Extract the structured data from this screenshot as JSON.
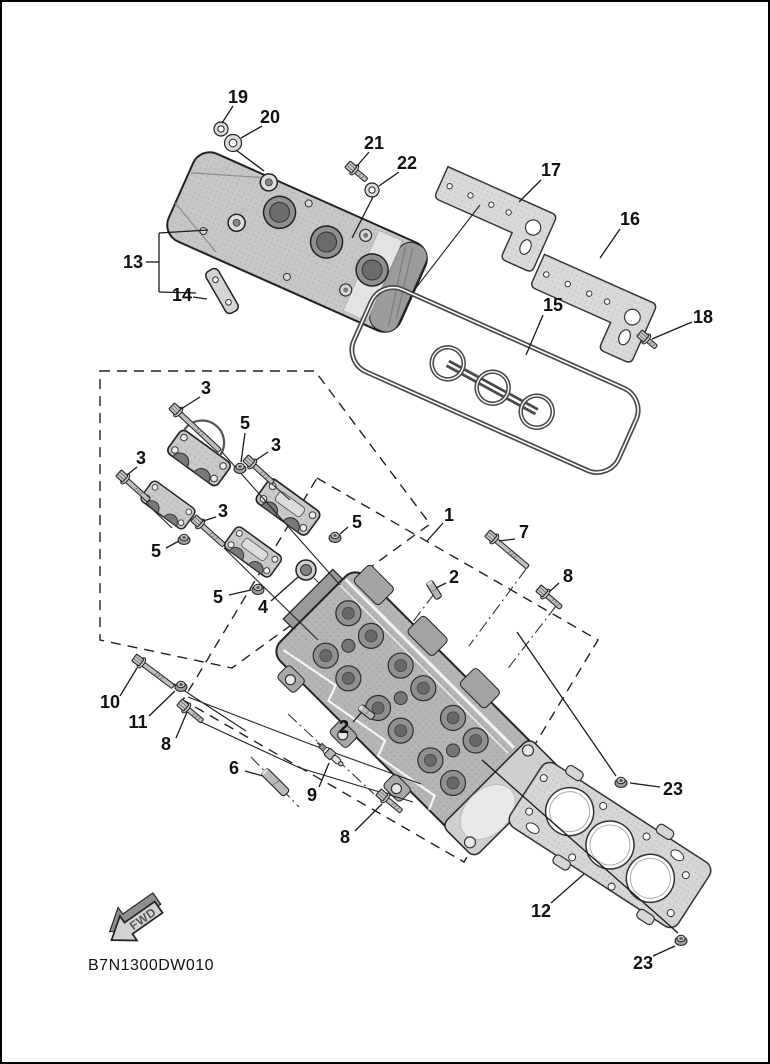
{
  "diagram": {
    "code": "B7N1300DW010",
    "fwd_label": "FWD"
  },
  "colors": {
    "background": "#ffffff",
    "line": "#1a1a1a",
    "label": "#111111",
    "metal_light": "#d9d9d9",
    "metal_mid": "#bdbdbd",
    "metal_dark": "#8f8f8f"
  },
  "callouts": [
    {
      "label": "19",
      "x": 238,
      "y": 97,
      "leaders": [
        [
          233,
          106,
          222,
          123
        ]
      ]
    },
    {
      "label": "20",
      "x": 270,
      "y": 117,
      "leaders": [
        [
          262,
          126,
          241,
          138
        ],
        [
          236,
          150,
          264,
          171
        ]
      ]
    },
    {
      "label": "21",
      "x": 374,
      "y": 143,
      "leaders": [
        [
          369,
          152,
          357,
          166
        ]
      ]
    },
    {
      "label": "22",
      "x": 407,
      "y": 163,
      "leaders": [
        [
          399,
          172,
          379,
          186
        ],
        [
          373,
          197,
          352,
          238
        ]
      ]
    },
    {
      "label": "17",
      "x": 551,
      "y": 170,
      "leaders": [
        [
          541,
          180,
          519,
          202
        ]
      ]
    },
    {
      "label": "16",
      "x": 630,
      "y": 219,
      "leaders": [
        [
          620,
          229,
          600,
          258
        ]
      ]
    },
    {
      "label": "18",
      "x": 703,
      "y": 317,
      "leaders": [
        [
          692,
          322,
          652,
          339
        ]
      ]
    },
    {
      "label": "15",
      "x": 553,
      "y": 305,
      "leaders": [
        [
          543,
          315,
          526,
          355
        ]
      ]
    },
    {
      "label": "13",
      "x": 133,
      "y": 262,
      "leaders": [
        [
          146,
          262,
          159,
          262
        ],
        [
          159,
          233,
          159,
          292
        ],
        [
          159,
          233,
          208,
          230
        ],
        [
          159,
          292,
          196,
          293
        ]
      ]
    },
    {
      "label": "14",
      "x": 182,
      "y": 295,
      "leaders": [
        [
          193,
          297,
          207,
          299
        ]
      ]
    },
    {
      "label": "3",
      "x": 206,
      "y": 388,
      "leaders": [
        [
          200,
          397,
          181,
          409
        ]
      ]
    },
    {
      "label": "5",
      "x": 245,
      "y": 423,
      "leaders": [
        [
          245,
          433,
          241,
          462
        ]
      ]
    },
    {
      "label": "3",
      "x": 276,
      "y": 445,
      "leaders": [
        [
          268,
          452,
          256,
          460
        ]
      ]
    },
    {
      "label": "3",
      "x": 141,
      "y": 458,
      "leaders": [
        [
          137,
          467,
          127,
          475
        ]
      ]
    },
    {
      "label": "3",
      "x": 223,
      "y": 511,
      "leaders": [
        [
          216,
          517,
          203,
          521
        ]
      ]
    },
    {
      "label": "5",
      "x": 156,
      "y": 551,
      "leaders": [
        [
          166,
          548,
          179,
          541
        ]
      ]
    },
    {
      "label": "5",
      "x": 357,
      "y": 522,
      "leaders": [
        [
          348,
          527,
          340,
          534
        ]
      ]
    },
    {
      "label": "5",
      "x": 218,
      "y": 597,
      "leaders": [
        [
          229,
          595,
          251,
          590
        ]
      ]
    },
    {
      "label": "4",
      "x": 263,
      "y": 607,
      "leaders": [
        [
          271,
          601,
          298,
          577
        ]
      ]
    },
    {
      "label": "1",
      "x": 449,
      "y": 515,
      "leaders": [
        [
          443,
          523,
          427,
          541
        ]
      ]
    },
    {
      "label": "7",
      "x": 524,
      "y": 532,
      "leaders": [
        [
          515,
          539,
          499,
          541
        ]
      ]
    },
    {
      "label": "2",
      "x": 454,
      "y": 577,
      "leaders": [
        [
          446,
          583,
          436,
          588
        ]
      ]
    },
    {
      "label": "8",
      "x": 568,
      "y": 576,
      "leaders": [
        [
          559,
          583,
          549,
          592
        ]
      ]
    },
    {
      "label": "10",
      "x": 110,
      "y": 702,
      "leaders": [
        [
          120,
          696,
          137,
          668
        ]
      ]
    },
    {
      "label": "11",
      "x": 138,
      "y": 722,
      "leaders": [
        [
          149,
          716,
          175,
          691
        ]
      ]
    },
    {
      "label": "8",
      "x": 166,
      "y": 744,
      "leaders": [
        [
          176,
          738,
          187,
          712
        ]
      ]
    },
    {
      "label": "6",
      "x": 234,
      "y": 768,
      "leaders": [
        [
          245,
          771,
          263,
          776
        ]
      ]
    },
    {
      "label": "9",
      "x": 312,
      "y": 795,
      "leaders": [
        [
          319,
          787,
          329,
          763
        ]
      ]
    },
    {
      "label": "8",
      "x": 345,
      "y": 837,
      "leaders": [
        [
          355,
          831,
          382,
          804
        ]
      ]
    },
    {
      "label": "2",
      "x": 344,
      "y": 727,
      "leaders": [
        [
          353,
          722,
          361,
          713
        ]
      ]
    },
    {
      "label": "23",
      "x": 673,
      "y": 789,
      "leaders": [
        [
          660,
          787,
          630,
          783
        ],
        [
          616,
          776,
          517,
          632
        ]
      ]
    },
    {
      "label": "12",
      "x": 541,
      "y": 911,
      "leaders": [
        [
          551,
          903,
          584,
          874
        ]
      ]
    },
    {
      "label": "23",
      "x": 643,
      "y": 963,
      "leaders": [
        [
          653,
          956,
          675,
          946
        ],
        [
          678,
          933,
          482,
          760
        ]
      ]
    }
  ],
  "dashed_boxes": [
    {
      "points": [
        [
          100,
          371
        ],
        [
          315,
          371
        ],
        [
          430,
          524
        ],
        [
          232,
          668
        ],
        [
          100,
          640
        ]
      ]
    },
    {
      "points": [
        [
          317,
          478
        ],
        [
          598,
          640
        ],
        [
          464,
          862
        ],
        [
          183,
          700
        ]
      ]
    }
  ],
  "centerlines": [
    [
      [
        288,
        714
      ],
      [
        374,
        794
      ]
    ],
    [
      [
        251,
        757
      ],
      [
        299,
        807
      ]
    ],
    [
      [
        526,
        569
      ],
      [
        469,
        646
      ]
    ],
    [
      [
        556,
        606
      ],
      [
        506,
        671
      ]
    ],
    [
      [
        434,
        594
      ],
      [
        390,
        652
      ]
    ],
    [
      [
        314,
        578
      ],
      [
        352,
        617
      ]
    ]
  ],
  "assembly_lines": [
    [
      [
        174,
        684
      ],
      [
        246,
        731
      ]
    ],
    [
      [
        188,
        697
      ],
      [
        310,
        744
      ],
      [
        421,
        784
      ]
    ],
    [
      [
        201,
        722
      ],
      [
        300,
        768
      ],
      [
        413,
        802
      ]
    ],
    [
      [
        222,
        452
      ],
      [
        340,
        585
      ]
    ],
    [
      [
        224,
        548
      ],
      [
        318,
        640
      ]
    ],
    [
      [
        146,
        503
      ],
      [
        172,
        528
      ]
    ],
    [
      [
        271,
        483
      ],
      [
        290,
        500
      ]
    ],
    [
      [
        480,
        205
      ],
      [
        412,
        293
      ]
    ]
  ],
  "fasteners": [
    {
      "type": "washer",
      "name": "washer-19",
      "x": 221,
      "y": 129,
      "r": 7
    },
    {
      "type": "washer",
      "name": "grommet-20",
      "x": 233,
      "y": 143,
      "r": 8.5
    },
    {
      "type": "flange_bolt",
      "name": "bolt-21",
      "x": 352,
      "y": 168,
      "angle": 40,
      "len": 14
    },
    {
      "type": "washer",
      "name": "washer-22",
      "x": 372,
      "y": 190,
      "r": 7
    },
    {
      "type": "flange_bolt",
      "name": "bolt-18",
      "x": 644,
      "y": 337,
      "angle": 40,
      "len": 11
    },
    {
      "type": "flange_bolt",
      "name": "bolt-3a",
      "x": 176,
      "y": 410,
      "angle": 43,
      "len": 55
    },
    {
      "type": "flange_bolt",
      "name": "bolt-3b",
      "x": 123,
      "y": 477,
      "angle": 42,
      "len": 30
    },
    {
      "type": "flange_bolt",
      "name": "bolt-3c",
      "x": 250,
      "y": 462,
      "angle": 42,
      "len": 26
    },
    {
      "type": "flange_bolt",
      "name": "bolt-3d",
      "x": 198,
      "y": 522,
      "angle": 42,
      "len": 30
    },
    {
      "type": "nut",
      "name": "nut-5a",
      "x": 240,
      "y": 468
    },
    {
      "type": "nut",
      "name": "nut-5b",
      "x": 184,
      "y": 539
    },
    {
      "type": "nut",
      "name": "nut-5c",
      "x": 335,
      "y": 537
    },
    {
      "type": "nut",
      "name": "nut-5d",
      "x": 258,
      "y": 589
    },
    {
      "type": "plug",
      "name": "plug-4",
      "x": 306,
      "y": 570,
      "r": 10
    },
    {
      "type": "flange_bolt",
      "name": "bolt-7",
      "x": 492,
      "y": 537,
      "angle": 40,
      "len": 42
    },
    {
      "type": "flange_bolt",
      "name": "bolt-8-right",
      "x": 543,
      "y": 592,
      "angle": 41,
      "len": 19
    },
    {
      "type": "stud",
      "name": "stud-2-upper",
      "x": 429,
      "y": 582,
      "angle": 58,
      "len": 19,
      "w": 7
    },
    {
      "type": "stud",
      "name": "stud-2-lower",
      "x": 360,
      "y": 707,
      "angle": 38,
      "len": 17,
      "w": 7
    },
    {
      "type": "flange_bolt",
      "name": "bolt-10",
      "x": 139,
      "y": 661,
      "angle": 37,
      "len": 38
    },
    {
      "type": "nut",
      "name": "nut-11",
      "x": 181,
      "y": 686
    },
    {
      "type": "flange_bolt",
      "name": "bolt-8-left",
      "x": 184,
      "y": 706,
      "angle": 40,
      "len": 19
    },
    {
      "type": "stud",
      "name": "stud-6",
      "x": 264,
      "y": 771,
      "angle": 45,
      "len": 32,
      "w": 9
    },
    {
      "type": "spark_plug",
      "name": "spark-plug-9",
      "x": 330,
      "y": 754,
      "angle": 42
    },
    {
      "type": "flange_bolt",
      "name": "bolt-8-bottom",
      "x": 383,
      "y": 796,
      "angle": 40,
      "len": 19
    },
    {
      "type": "nut",
      "name": "nut-23-upper",
      "x": 621,
      "y": 782
    },
    {
      "type": "nut",
      "name": "nut-23-lower",
      "x": 681,
      "y": 940
    }
  ]
}
